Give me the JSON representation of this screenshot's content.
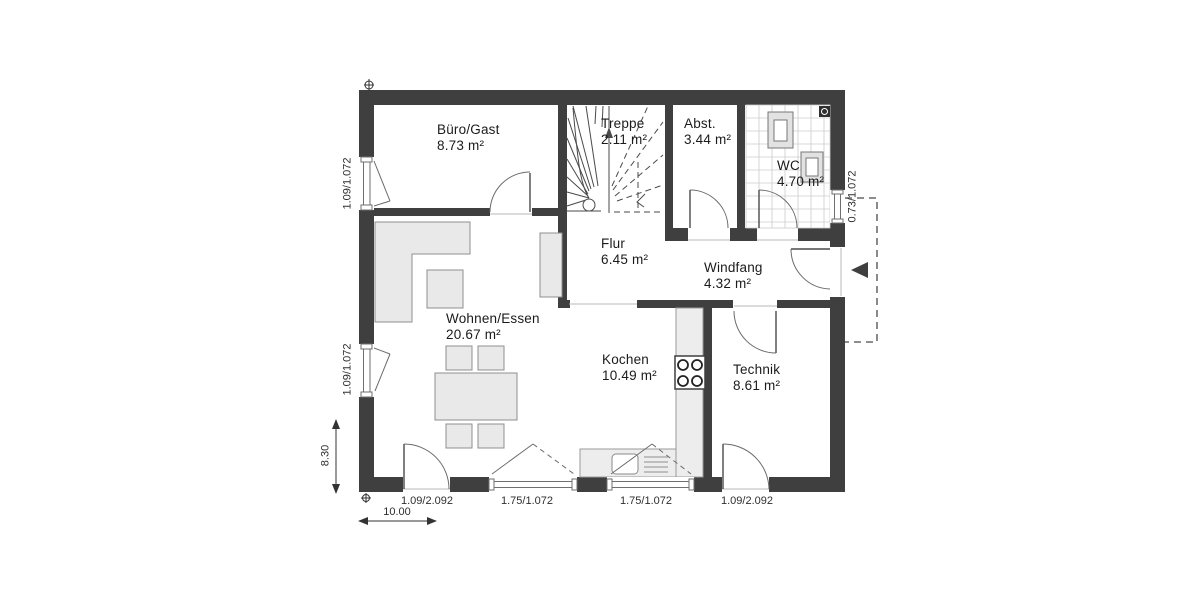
{
  "plan": {
    "rooms": [
      {
        "name": "Büro/Gast",
        "area": "8.73 m²"
      },
      {
        "name": "Treppe",
        "area": "2.11 m²"
      },
      {
        "name": "Abst.",
        "area": "3.44 m²"
      },
      {
        "name": "WC",
        "area": "4.70 m²"
      },
      {
        "name": "Flur",
        "area": "6.45 m²"
      },
      {
        "name": "Windfang",
        "area": "4.32 m²"
      },
      {
        "name": "Wohnen/Essen",
        "area": "20.67 m²"
      },
      {
        "name": "Kochen",
        "area": "10.49 m²"
      },
      {
        "name": "Technik",
        "area": "8.61 m²"
      }
    ],
    "dims": {
      "left_upper": "1.09/1.072",
      "left_lower": "1.09/1.072",
      "right_wc": "0.73/1.072",
      "bottom": [
        "1.09/2.092",
        "1.75/1.072",
        "1.75/1.072",
        "1.09/2.092"
      ],
      "total_width": "10.00",
      "total_height": "8.30"
    },
    "colors": {
      "wall": "#3f3f3f",
      "furniture_fill": "#e9e9e9",
      "counter_fill": "#ededed",
      "line": "#4a4a4a",
      "tile": "#cccccc",
      "background": "#ffffff"
    }
  }
}
